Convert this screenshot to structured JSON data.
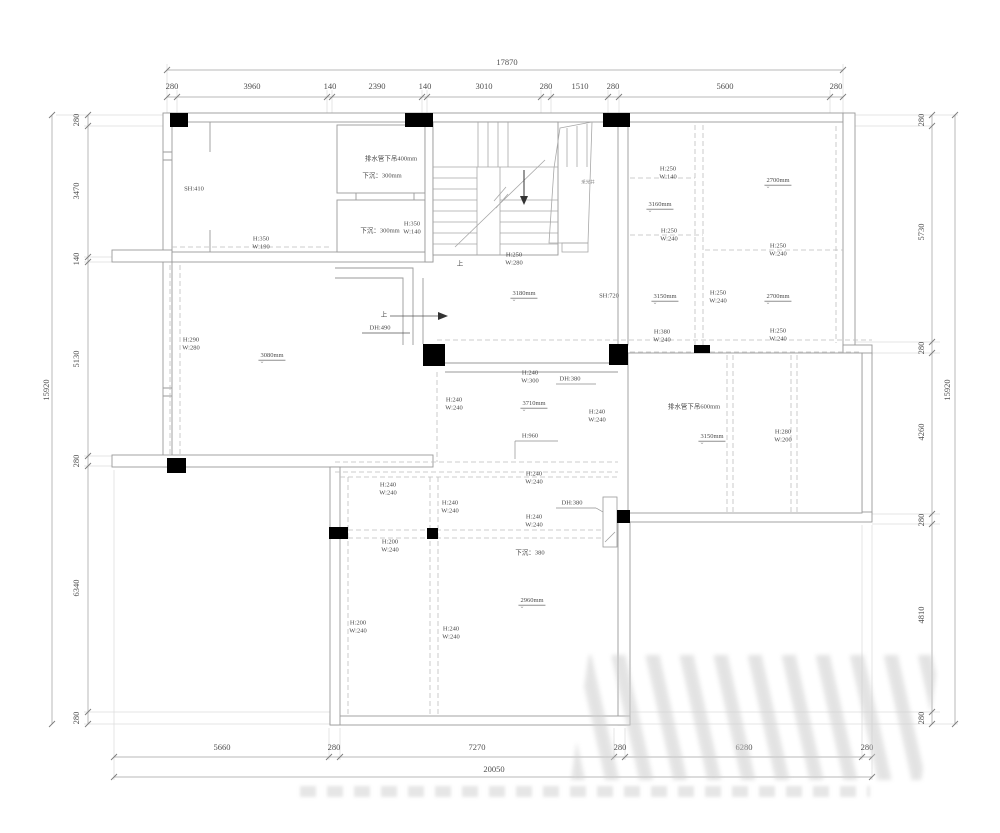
{
  "colors": {
    "wall": "#9a9a9a",
    "dash": "#bdbdbd",
    "dim_line": "#b8b8b8",
    "column": "#000000",
    "text": "#4a4a4a",
    "dim_text": "#4f4f4f"
  },
  "dimensions": {
    "top": {
      "label_y": 86,
      "overall": {
        "t": "17870",
        "x": 507,
        "y": 62
      },
      "items": [
        {
          "t": "280",
          "x": 172
        },
        {
          "t": "3960",
          "x": 252
        },
        {
          "t": "140",
          "x": 330
        },
        {
          "t": "2390",
          "x": 377
        },
        {
          "t": "140",
          "x": 425
        },
        {
          "t": "3010",
          "x": 484
        },
        {
          "t": "280",
          "x": 546
        },
        {
          "t": "1510",
          "x": 580
        },
        {
          "t": "280",
          "x": 613
        },
        {
          "t": "5600",
          "x": 725
        },
        {
          "t": "280",
          "x": 836
        }
      ]
    },
    "bottom": {
      "label_y": 747,
      "overall": {
        "t": "20050",
        "x": 494,
        "y": 769
      },
      "items": [
        {
          "t": "5660",
          "x": 222
        },
        {
          "t": "280",
          "x": 334
        },
        {
          "t": "7270",
          "x": 477
        },
        {
          "t": "280",
          "x": 620
        },
        {
          "t": "6280",
          "x": 744
        },
        {
          "t": "280",
          "x": 867
        }
      ]
    },
    "left": {
      "label_x": 76,
      "overall": {
        "t": "15920",
        "x": 46,
        "y": 390
      },
      "items": [
        {
          "t": "280",
          "y": 120
        },
        {
          "t": "3470",
          "y": 191
        },
        {
          "t": "140",
          "y": 259
        },
        {
          "t": "5130",
          "y": 359
        },
        {
          "t": "280",
          "y": 461
        },
        {
          "t": "6340",
          "y": 588
        },
        {
          "t": "280",
          "y": 718
        }
      ]
    },
    "right": {
      "label_x": 921,
      "overall": {
        "t": "15920",
        "x": 947,
        "y": 390
      },
      "items": [
        {
          "t": "280",
          "y": 120
        },
        {
          "t": "5730",
          "y": 232
        },
        {
          "t": "280",
          "y": 348
        },
        {
          "t": "4260",
          "y": 432
        },
        {
          "t": "280",
          "y": 520
        },
        {
          "t": "4810",
          "y": 615
        },
        {
          "t": "280",
          "y": 718
        }
      ]
    }
  },
  "plan": {
    "labels": [
      {
        "name": "sill-height-label",
        "x": 194,
        "y": 189,
        "lines": [
          "SH:410"
        ]
      },
      {
        "name": "beam-size-label",
        "x": 261,
        "y": 243,
        "lines": [
          "H:350",
          "W:190"
        ]
      },
      {
        "name": "drain-pipe-note",
        "x": 391,
        "y": 159,
        "lines": [
          "排水管下吊400mm"
        ]
      },
      {
        "name": "sunken-note",
        "x": 382,
        "y": 176,
        "lines": [
          "下沉：300mm"
        ]
      },
      {
        "name": "sunken-note",
        "x": 380,
        "y": 231,
        "lines": [
          "下沉：300mm"
        ]
      },
      {
        "name": "beam-size-label",
        "x": 412,
        "y": 228,
        "lines": [
          "H:350",
          "W:140"
        ]
      },
      {
        "name": "beam-size-label",
        "x": 514,
        "y": 259,
        "lines": [
          "H:250",
          "W:280"
        ]
      },
      {
        "name": "stair-up-label",
        "x": 460,
        "y": 264,
        "lines": [
          "上"
        ]
      },
      {
        "name": "ceiling-height-label",
        "x": 524,
        "y": 294,
        "lines": [
          "3180mm"
        ],
        "cls": "lvl"
      },
      {
        "name": "sill-height-label",
        "x": 609,
        "y": 296,
        "lines": [
          "SH:720"
        ]
      },
      {
        "name": "up-direction-label",
        "x": 384,
        "y": 315,
        "lines": [
          "上"
        ]
      },
      {
        "name": "door-height-label",
        "x": 380,
        "y": 328,
        "lines": [
          "DH:490"
        ]
      },
      {
        "name": "beam-size-label",
        "x": 191,
        "y": 344,
        "lines": [
          "H:290",
          "W:280"
        ]
      },
      {
        "name": "ceiling-height-label",
        "x": 272,
        "y": 356,
        "lines": [
          "3080mm"
        ],
        "cls": "lvl"
      },
      {
        "name": "lightwell-label",
        "x": 588,
        "y": 182,
        "lines": [
          "采光井"
        ],
        "cls": "tiny"
      },
      {
        "name": "beam-size-label",
        "x": 668,
        "y": 173,
        "lines": [
          "H:250",
          "W:140"
        ]
      },
      {
        "name": "ceiling-height-label",
        "x": 778,
        "y": 181,
        "lines": [
          "2700mm"
        ],
        "cls": "lvl"
      },
      {
        "name": "ceiling-height-label",
        "x": 660,
        "y": 205,
        "lines": [
          "3160mm"
        ],
        "cls": "lvl"
      },
      {
        "name": "beam-size-label",
        "x": 669,
        "y": 235,
        "lines": [
          "H:250",
          "W:240"
        ]
      },
      {
        "name": "beam-size-label",
        "x": 778,
        "y": 250,
        "lines": [
          "H:250",
          "W:240"
        ]
      },
      {
        "name": "ceiling-height-label",
        "x": 665,
        "y": 297,
        "lines": [
          "3150mm"
        ],
        "cls": "lvl"
      },
      {
        "name": "beam-size-label",
        "x": 718,
        "y": 297,
        "lines": [
          "H:250",
          "W:240"
        ]
      },
      {
        "name": "ceiling-height-label",
        "x": 778,
        "y": 297,
        "lines": [
          "2700mm"
        ],
        "cls": "lvl"
      },
      {
        "name": "beam-size-label",
        "x": 662,
        "y": 336,
        "lines": [
          "H:380",
          "W:240"
        ]
      },
      {
        "name": "beam-size-label",
        "x": 778,
        "y": 335,
        "lines": [
          "H:250",
          "W:240"
        ]
      },
      {
        "name": "beam-size-label",
        "x": 530,
        "y": 377,
        "lines": [
          "H:240",
          "W:300"
        ]
      },
      {
        "name": "door-height-label",
        "x": 570,
        "y": 379,
        "lines": [
          "DH:380"
        ]
      },
      {
        "name": "beam-size-label",
        "x": 454,
        "y": 404,
        "lines": [
          "H:240",
          "W:240"
        ]
      },
      {
        "name": "ceiling-height-label",
        "x": 534,
        "y": 404,
        "lines": [
          "3710mm"
        ],
        "cls": "lvl"
      },
      {
        "name": "beam-size-label",
        "x": 597,
        "y": 416,
        "lines": [
          "H:240",
          "W:240"
        ]
      },
      {
        "name": "height-label",
        "x": 530,
        "y": 436,
        "lines": [
          "H:960"
        ]
      },
      {
        "name": "drain-pipe-note",
        "x": 694,
        "y": 407,
        "lines": [
          "排水管下吊600mm"
        ]
      },
      {
        "name": "ceiling-height-label",
        "x": 712,
        "y": 437,
        "lines": [
          "3150mm"
        ],
        "cls": "lvl"
      },
      {
        "name": "beam-size-label",
        "x": 783,
        "y": 436,
        "lines": [
          "H:280",
          "W:200"
        ]
      },
      {
        "name": "beam-size-label",
        "x": 388,
        "y": 489,
        "lines": [
          "H:240",
          "W:240"
        ]
      },
      {
        "name": "beam-size-label",
        "x": 450,
        "y": 507,
        "lines": [
          "H:240",
          "W:240"
        ]
      },
      {
        "name": "beam-size-label",
        "x": 534,
        "y": 478,
        "lines": [
          "H:240",
          "W:240"
        ]
      },
      {
        "name": "door-height-label",
        "x": 572,
        "y": 503,
        "lines": [
          "DH:380"
        ]
      },
      {
        "name": "beam-size-label",
        "x": 534,
        "y": 521,
        "lines": [
          "H:240",
          "W:240"
        ]
      },
      {
        "name": "beam-size-label",
        "x": 390,
        "y": 546,
        "lines": [
          "H:200",
          "W:240"
        ]
      },
      {
        "name": "sunken-note",
        "x": 530,
        "y": 553,
        "lines": [
          "下沉：380"
        ]
      },
      {
        "name": "ceiling-height-label",
        "x": 532,
        "y": 601,
        "lines": [
          "2960mm"
        ],
        "cls": "lvl"
      },
      {
        "name": "beam-size-label",
        "x": 358,
        "y": 627,
        "lines": [
          "H:200",
          "W:240"
        ]
      },
      {
        "name": "beam-size-label",
        "x": 451,
        "y": 633,
        "lines": [
          "H:240",
          "W:240"
        ]
      }
    ]
  }
}
